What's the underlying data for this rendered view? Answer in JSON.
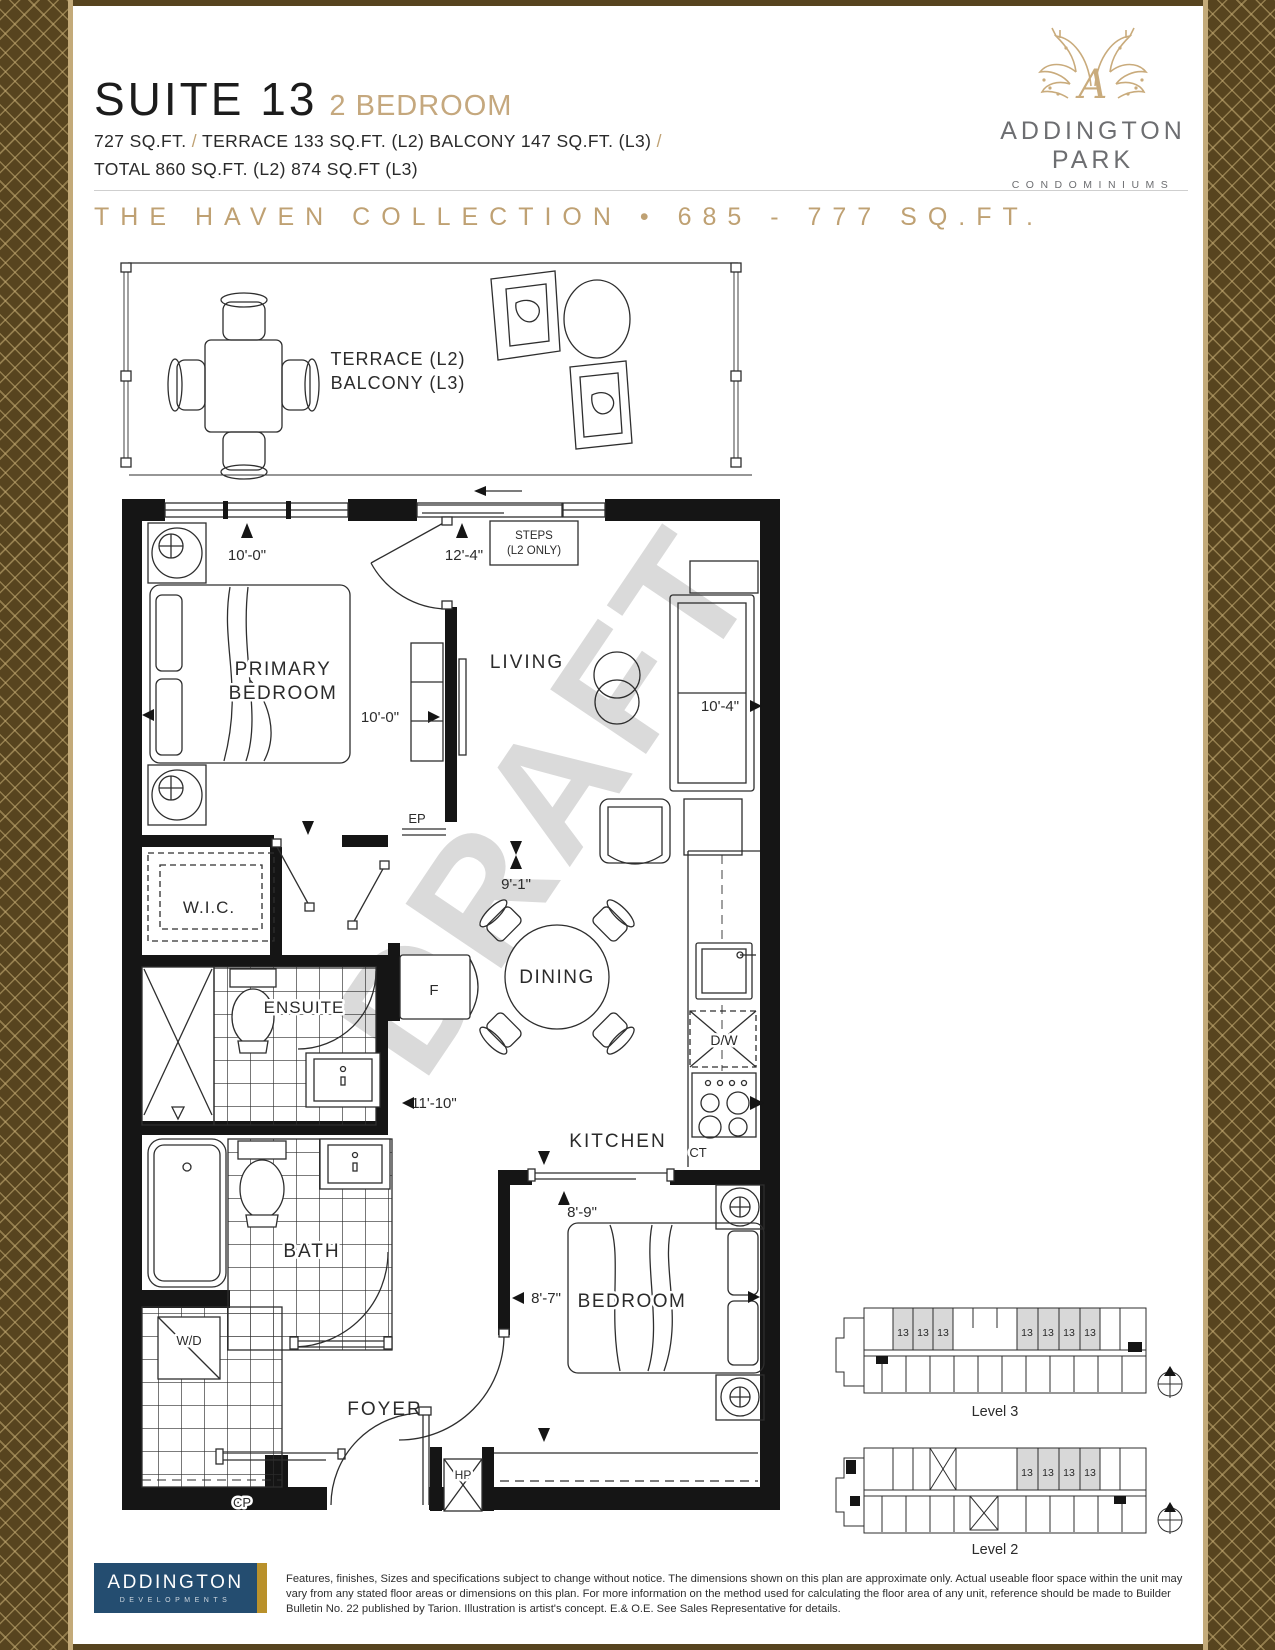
{
  "header": {
    "suite_title": "SUITE 13",
    "suite_subtitle": "2 BEDROOM",
    "area": {
      "p1": "727 SQ.FT.",
      "sep1": "/",
      "p2": "TERRACE 133 SQ.FT. (L2) BALCONY 147 SQ.FT. (L3)",
      "sep2": "/",
      "line2": "TOTAL 860 SQ.FT. (L2) 874 SQ.FT (L3)"
    },
    "collection_banner": "THE HAVEN COLLECTION • 685 - 777 SQ.FT."
  },
  "brand": {
    "monogram": "A",
    "name_line1": "ADDINGTON",
    "name_line2": "PARK",
    "tagline": "CONDOMINIUMS"
  },
  "floorplan": {
    "watermark": "DRAFT",
    "rooms": {
      "terrace_l2": "TERRACE (L2)",
      "balcony_l3": "BALCONY (L3)",
      "primary_1": "PRIMARY",
      "primary_2": "BEDROOM",
      "living": "LIVING",
      "wic": "W.I.C.",
      "ensuite": "ENSUITE",
      "dining": "DINING",
      "kitchen": "KITCHEN",
      "bath": "BATH",
      "bedroom": "BEDROOM",
      "foyer": "FOYER"
    },
    "dims": {
      "d_top_primary": "10'-0\"",
      "d_top_living": "12'-4\"",
      "d_primary": "10'-0\"",
      "d_living": "10'-4\"",
      "d_dining": "9'-1\"",
      "d_hall": "11'-10\"",
      "d_bed_w": "8'-9\"",
      "d_bed_d": "8'-7\""
    },
    "notes": {
      "steps_1": "STEPS",
      "steps_2": "(L2 ONLY)",
      "ep": "EP",
      "fridge": "F",
      "dishwasher": "D/W",
      "cooktop": "CT",
      "washer_dryer": "W/D",
      "cp": "CP",
      "heat_pump": "HP"
    }
  },
  "keyplans": {
    "level3": {
      "caption": "Level 3",
      "units": [
        "13",
        "13",
        "13",
        "13",
        "13",
        "13",
        "13"
      ]
    },
    "level2": {
      "caption": "Level 2",
      "units": [
        "13",
        "13",
        "13",
        "13"
      ]
    }
  },
  "footer": {
    "developer_line1": "ADDINGTON",
    "developer_line2": "DEVELOPMENTS",
    "disclaimer": "Features, finishes, Sizes and specifications subject to change without notice. The dimensions shown on this plan are approximate only. Actual useable floor space within the unit may vary from any stated floor areas or dimensions on this plan. For more information on the method used for calculating the floor area of any unit, reference should be made to Builder Bulletin No. 22 published by Tarion. Illustration is artist's concept. E.& O.E.  See Sales Representative for details."
  },
  "colors": {
    "accent": "#bfa173",
    "border_brown": "#57441f",
    "navy": "#244d70",
    "gold": "#b9912b"
  }
}
